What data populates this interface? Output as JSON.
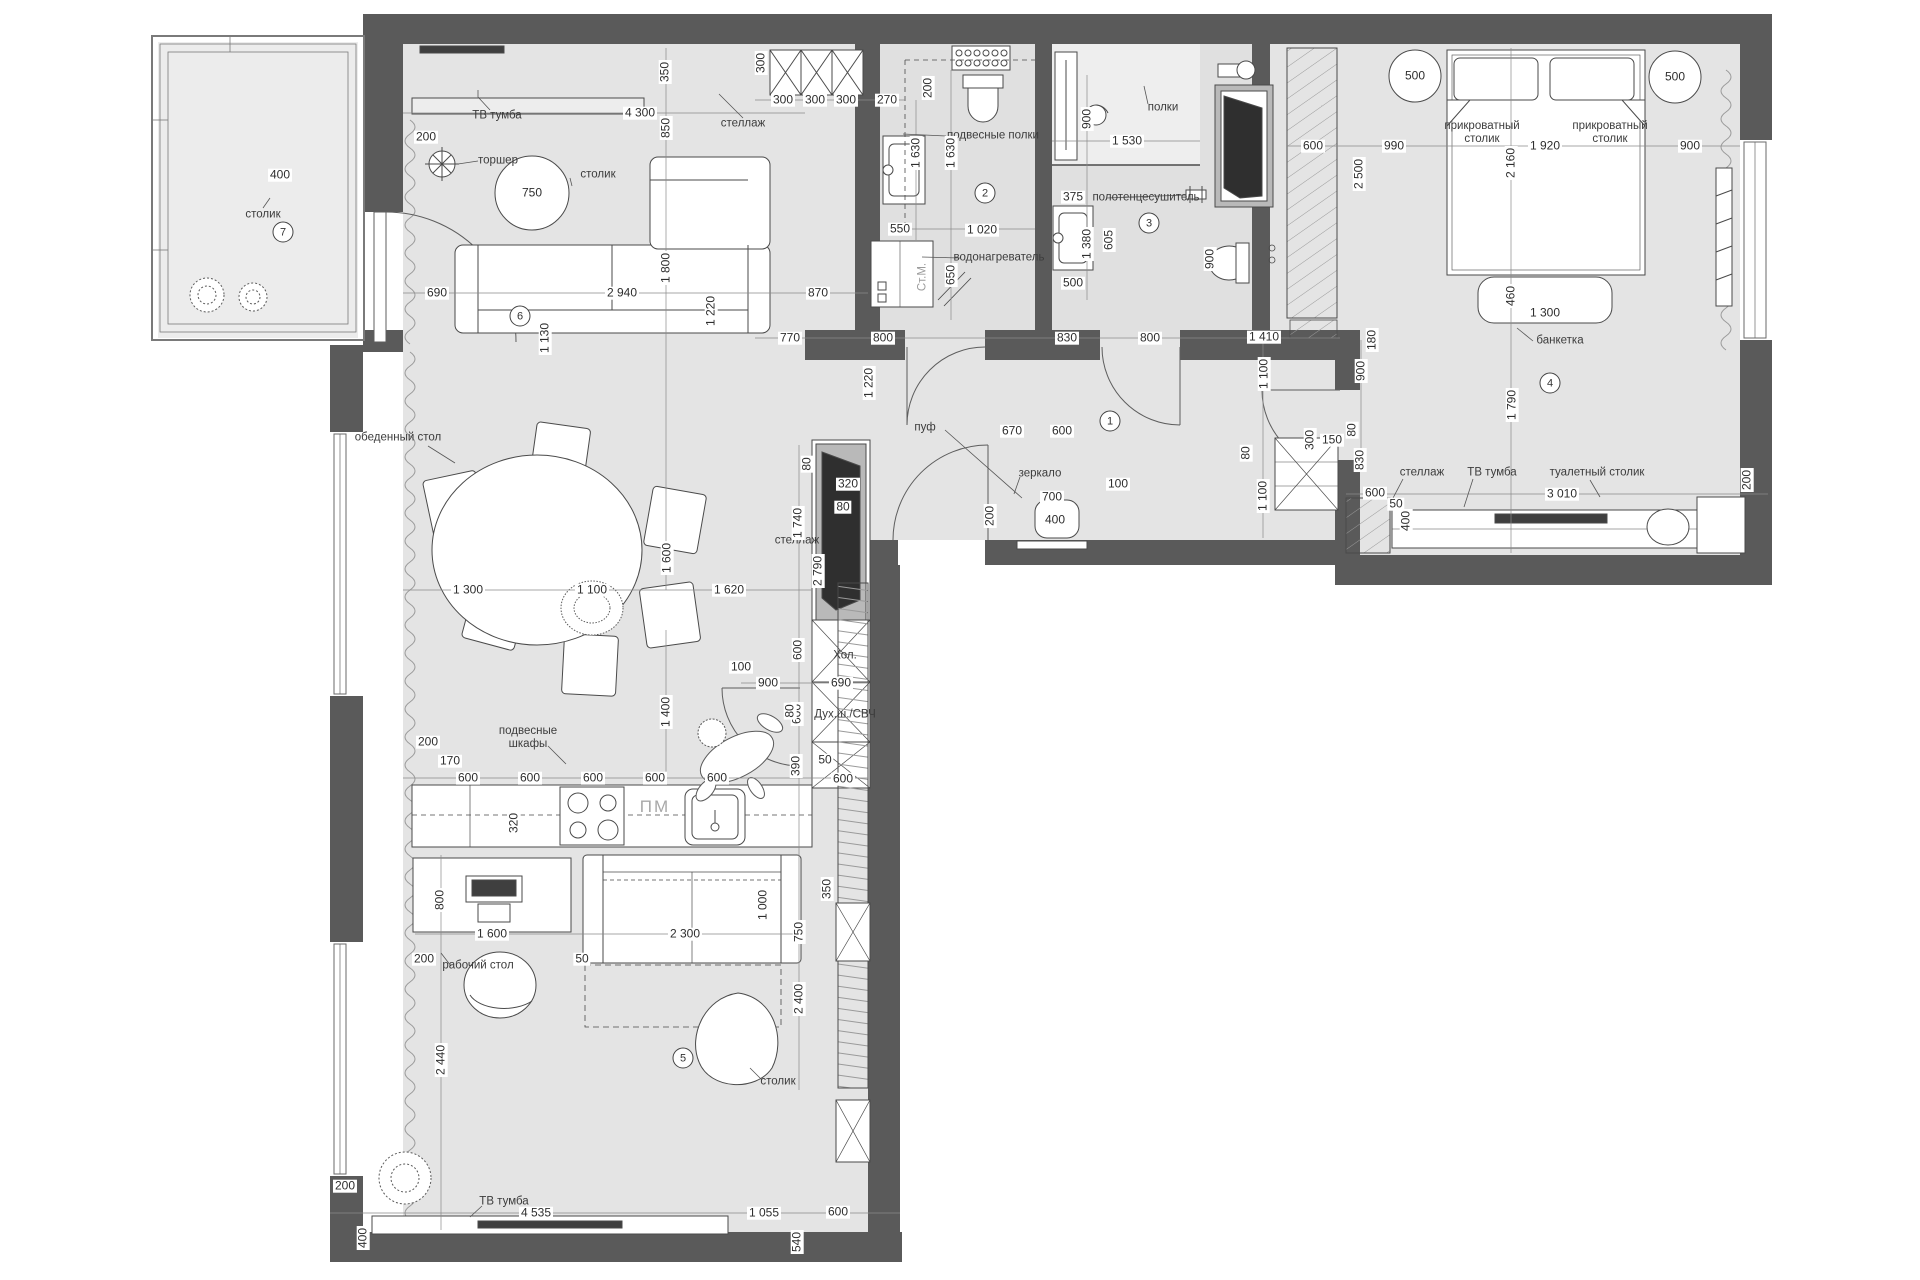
{
  "title": "Поэтажный план квартиры (apartment floor plan)",
  "units": "mm",
  "colors": {
    "wall": "#5a5a5a",
    "floor": "#e4e4e4",
    "bath_floor": "#e0e0e0",
    "balcony_floor": "#ececec",
    "line": "#4a4a4a",
    "dim_line": "#8a8a8a",
    "chip_text": "#2e2e2e"
  },
  "rooms": [
    {
      "num": "1",
      "x": 1110,
      "y": 421
    },
    {
      "num": "2",
      "x": 985,
      "y": 193
    },
    {
      "num": "3",
      "x": 1149,
      "y": 223
    },
    {
      "num": "4",
      "x": 1550,
      "y": 383
    },
    {
      "num": "5",
      "x": 683,
      "y": 1058
    },
    {
      "num": "6",
      "x": 520,
      "y": 316
    },
    {
      "num": "7",
      "x": 283,
      "y": 232
    }
  ],
  "dims": [
    {
      "t": "200",
      "x": 426,
      "y": 137
    },
    {
      "t": "4 300",
      "x": 640,
      "y": 113
    },
    {
      "t": "350",
      "x": 665,
      "y": 72,
      "v": 1
    },
    {
      "t": "850",
      "x": 666,
      "y": 128,
      "v": 1
    },
    {
      "t": "300",
      "x": 761,
      "y": 63,
      "v": 1
    },
    {
      "t": "300",
      "x": 783,
      "y": 100
    },
    {
      "t": "300",
      "x": 815,
      "y": 100
    },
    {
      "t": "300",
      "x": 846,
      "y": 100
    },
    {
      "t": "270",
      "x": 887,
      "y": 100
    },
    {
      "t": "200",
      "x": 928,
      "y": 88,
      "v": 1
    },
    {
      "t": "690",
      "x": 437,
      "y": 293
    },
    {
      "t": "2 940",
      "x": 622,
      "y": 293
    },
    {
      "t": "870",
      "x": 818,
      "y": 293
    },
    {
      "t": "1 800",
      "x": 666,
      "y": 268,
      "v": 1
    },
    {
      "t": "1 130",
      "x": 545,
      "y": 338,
      "v": 1
    },
    {
      "t": "1 220",
      "x": 711,
      "y": 311,
      "v": 1
    },
    {
      "t": "1 220",
      "x": 869,
      "y": 383,
      "v": 1
    },
    {
      "t": "1 300",
      "x": 468,
      "y": 590
    },
    {
      "t": "1 100",
      "x": 592,
      "y": 590
    },
    {
      "t": "1 620",
      "x": 729,
      "y": 590
    },
    {
      "t": "1 600",
      "x": 667,
      "y": 558,
      "v": 1
    },
    {
      "t": "1 400",
      "x": 666,
      "y": 712,
      "v": 1
    },
    {
      "t": "1 740",
      "x": 798,
      "y": 523,
      "v": 1
    },
    {
      "t": "600",
      "x": 798,
      "y": 650,
      "v": 1
    },
    {
      "t": "600",
      "x": 797,
      "y": 714,
      "v": 1
    },
    {
      "t": "390",
      "x": 796,
      "y": 766,
      "v": 1
    },
    {
      "t": "50",
      "x": 825,
      "y": 760
    },
    {
      "t": "600",
      "x": 843,
      "y": 779
    },
    {
      "t": "200",
      "x": 428,
      "y": 742
    },
    {
      "t": "170",
      "x": 450,
      "y": 761
    },
    {
      "t": "600",
      "x": 468,
      "y": 778
    },
    {
      "t": "600",
      "x": 530,
      "y": 778
    },
    {
      "t": "600",
      "x": 593,
      "y": 778
    },
    {
      "t": "600",
      "x": 655,
      "y": 778
    },
    {
      "t": "600",
      "x": 717,
      "y": 778
    },
    {
      "t": "320",
      "x": 514,
      "y": 823,
      "v": 1
    },
    {
      "t": "100",
      "x": 741,
      "y": 667
    },
    {
      "t": "900",
      "x": 768,
      "y": 683
    },
    {
      "t": "690",
      "x": 841,
      "y": 683
    },
    {
      "t": "80",
      "x": 790,
      "y": 711,
      "v": 1
    },
    {
      "t": "2 790",
      "x": 818,
      "y": 571,
      "v": 1
    },
    {
      "t": "350",
      "x": 827,
      "y": 889,
      "v": 1
    },
    {
      "t": "750",
      "x": 799,
      "y": 932,
      "v": 1
    },
    {
      "t": "2 400",
      "x": 799,
      "y": 999,
      "v": 1
    },
    {
      "t": "800",
      "x": 440,
      "y": 900,
      "v": 1
    },
    {
      "t": "1 600",
      "x": 492,
      "y": 934
    },
    {
      "t": "200",
      "x": 424,
      "y": 959
    },
    {
      "t": "50",
      "x": 582,
      "y": 959
    },
    {
      "t": "2 300",
      "x": 685,
      "y": 934
    },
    {
      "t": "1 000",
      "x": 763,
      "y": 905,
      "v": 1
    },
    {
      "t": "2 440",
      "x": 441,
      "y": 1060,
      "v": 1
    },
    {
      "t": "200",
      "x": 345,
      "y": 1186
    },
    {
      "t": "400",
      "x": 363,
      "y": 1238,
      "v": 1
    },
    {
      "t": "4 535",
      "x": 536,
      "y": 1213
    },
    {
      "t": "1 055",
      "x": 764,
      "y": 1213
    },
    {
      "t": "540",
      "x": 797,
      "y": 1242,
      "v": 1
    },
    {
      "t": "600",
      "x": 838,
      "y": 1212
    },
    {
      "t": "770",
      "x": 790,
      "y": 338
    },
    {
      "t": "800",
      "x": 883,
      "y": 338
    },
    {
      "t": "830",
      "x": 1067,
      "y": 338
    },
    {
      "t": "800",
      "x": 1150,
      "y": 338
    },
    {
      "t": "1 410",
      "x": 1264,
      "y": 337
    },
    {
      "t": "1 100",
      "x": 1264,
      "y": 374,
      "v": 1
    },
    {
      "t": "180",
      "x": 1372,
      "y": 340,
      "v": 1
    },
    {
      "t": "900",
      "x": 1361,
      "y": 371,
      "v": 1
    },
    {
      "t": "80",
      "x": 1246,
      "y": 453,
      "v": 1
    },
    {
      "t": "1 100",
      "x": 1263,
      "y": 496,
      "v": 1
    },
    {
      "t": "100",
      "x": 1118,
      "y": 484
    },
    {
      "t": "830",
      "x": 1360,
      "y": 460,
      "v": 1
    },
    {
      "t": "670",
      "x": 1012,
      "y": 431
    },
    {
      "t": "600",
      "x": 1062,
      "y": 431
    },
    {
      "t": "700",
      "x": 1052,
      "y": 497
    },
    {
      "t": "400",
      "x": 1055,
      "y": 520
    },
    {
      "t": "200",
      "x": 990,
      "y": 516,
      "v": 1
    },
    {
      "t": "80",
      "x": 807,
      "y": 464,
      "v": 1
    },
    {
      "t": "320",
      "x": 848,
      "y": 484
    },
    {
      "t": "80",
      "x": 843,
      "y": 507
    },
    {
      "t": "1 630",
      "x": 916,
      "y": 153,
      "v": 1
    },
    {
      "t": "1 630",
      "x": 951,
      "y": 153,
      "v": 1
    },
    {
      "t": "550",
      "x": 900,
      "y": 229
    },
    {
      "t": "1 020",
      "x": 982,
      "y": 230
    },
    {
      "t": "650",
      "x": 951,
      "y": 275,
      "v": 1
    },
    {
      "t": "375",
      "x": 1073,
      "y": 197
    },
    {
      "t": "500",
      "x": 1073,
      "y": 283
    },
    {
      "t": "900",
      "x": 1087,
      "y": 119,
      "v": 1
    },
    {
      "t": "1 530",
      "x": 1127,
      "y": 141
    },
    {
      "t": "1 380",
      "x": 1087,
      "y": 244,
      "v": 1
    },
    {
      "t": "605",
      "x": 1109,
      "y": 240,
      "v": 1
    },
    {
      "t": "900",
      "x": 1210,
      "y": 259,
      "v": 1
    },
    {
      "t": "600",
      "x": 1313,
      "y": 146
    },
    {
      "t": "2 500",
      "x": 1359,
      "y": 174,
      "v": 1
    },
    {
      "t": "990",
      "x": 1394,
      "y": 146
    },
    {
      "t": "1 920",
      "x": 1545,
      "y": 146
    },
    {
      "t": "900",
      "x": 1690,
      "y": 146
    },
    {
      "t": "2 160",
      "x": 1511,
      "y": 163,
      "v": 1
    },
    {
      "t": "460",
      "x": 1511,
      "y": 296,
      "v": 1
    },
    {
      "t": "1 300",
      "x": 1545,
      "y": 313
    },
    {
      "t": "1 790",
      "x": 1512,
      "y": 405,
      "v": 1
    },
    {
      "t": "600",
      "x": 1375,
      "y": 493
    },
    {
      "t": "3 010",
      "x": 1562,
      "y": 494
    },
    {
      "t": "200",
      "x": 1747,
      "y": 480,
      "v": 1
    },
    {
      "t": "300",
      "x": 1310,
      "y": 440,
      "v": 1
    },
    {
      "t": "150",
      "x": 1332,
      "y": 440
    },
    {
      "t": "80",
      "x": 1352,
      "y": 430,
      "v": 1
    },
    {
      "t": "400",
      "x": 1406,
      "y": 521,
      "v": 1
    },
    {
      "t": "50",
      "x": 1396,
      "y": 504
    },
    {
      "t": "500",
      "x": 1415,
      "y": 76
    },
    {
      "t": "500",
      "x": 1675,
      "y": 77
    },
    {
      "t": "750",
      "x": 532,
      "y": 193
    },
    {
      "t": "400",
      "x": 280,
      "y": 175
    }
  ],
  "labels": [
    {
      "t": "столик",
      "x": 263,
      "y": 215
    },
    {
      "t": "торшер",
      "x": 498,
      "y": 161
    },
    {
      "t": "столик",
      "x": 598,
      "y": 175
    },
    {
      "t": "ТВ тумба",
      "x": 497,
      "y": 116
    },
    {
      "t": "стеллаж",
      "x": 743,
      "y": 124
    },
    {
      "t": "подвесные полки",
      "x": 993,
      "y": 136
    },
    {
      "t": "водонагреватель",
      "x": 999,
      "y": 258
    },
    {
      "t": "Ст.М.",
      "x": 923,
      "y": 277,
      "cls": "v gray"
    },
    {
      "t": "полки",
      "x": 1163,
      "y": 108
    },
    {
      "t": "полотенцесушитель",
      "x": 1146,
      "y": 198
    },
    {
      "t": "прикроватный\nстолик",
      "x": 1482,
      "y": 133
    },
    {
      "t": "прикроватный\nстолик",
      "x": 1610,
      "y": 133
    },
    {
      "t": "банкетка",
      "x": 1560,
      "y": 341
    },
    {
      "t": "стеллаж",
      "x": 1422,
      "y": 473
    },
    {
      "t": "ТВ тумба",
      "x": 1492,
      "y": 473
    },
    {
      "t": "туалетный столик",
      "x": 1597,
      "y": 473
    },
    {
      "t": "зеркало",
      "x": 1040,
      "y": 474
    },
    {
      "t": "пуф",
      "x": 925,
      "y": 428
    },
    {
      "t": "обеденный стол",
      "x": 398,
      "y": 438
    },
    {
      "t": "подвесные\nшкафы",
      "x": 528,
      "y": 738
    },
    {
      "t": "ПМ",
      "x": 655,
      "y": 807,
      "cls": "gray big"
    },
    {
      "t": "Хол.",
      "x": 845,
      "y": 656
    },
    {
      "t": "Дух.ш./СВЧ",
      "x": 845,
      "y": 715
    },
    {
      "t": "рабочий стол",
      "x": 478,
      "y": 966
    },
    {
      "t": "столик",
      "x": 778,
      "y": 1082
    },
    {
      "t": "ТВ тумба",
      "x": 504,
      "y": 1202
    },
    {
      "t": "стеллаж",
      "x": 797,
      "y": 541
    }
  ]
}
